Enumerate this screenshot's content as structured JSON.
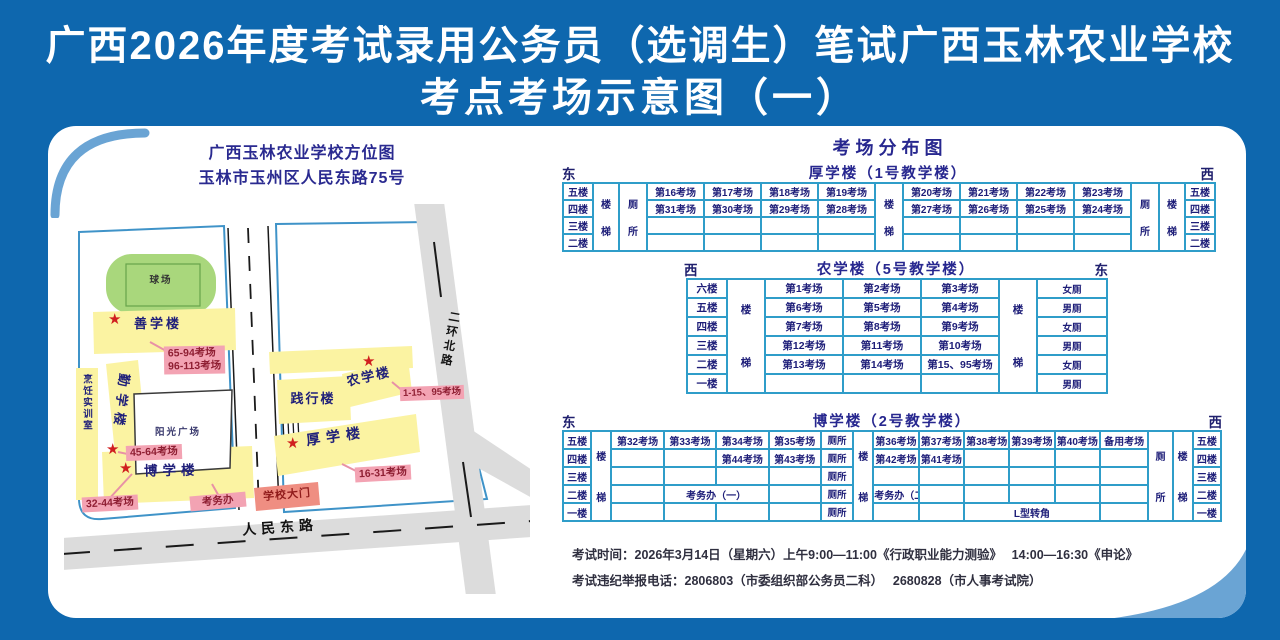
{
  "title": {
    "line1": "广西2026年度考试录用公务员（选调生）笔试广西玉林农业学校",
    "line2": "考点考场示意图（一）"
  },
  "icons": {
    "star": "★"
  },
  "colors": {
    "page_bg": "#0e67ae",
    "table_border": "#2f9dc9",
    "heading": "#27278f",
    "cell_text": "#1d1d78",
    "building_yellow": "#fbf3a2",
    "field_green": "#a9d77c",
    "pink_label_bg": "#f3a3b3",
    "pink_label_text": "#8f1f33",
    "gate_bg": "#ef8e82",
    "star_red": "#d01f1f",
    "road_gray": "#dcdcdc",
    "campus_line": "#3f93c8",
    "map_frame": "#37307e"
  },
  "map": {
    "heading_line1": "广西玉林农业学校方位图",
    "heading_line2": "玉林市玉州区人民东路75号",
    "buildings": {
      "sports_field": "球场",
      "shanxuelou": "善学楼",
      "qinxuelou": "勤学楼",
      "pengren": "烹饪实训室",
      "yangguang": "阳光广场",
      "boxuelou": "博学楼",
      "jianxinglou": "践行楼",
      "nongxuelou": "农学楼",
      "houxuelou": "厚学楼",
      "gate": "学校大门",
      "kaowuban": "考务办"
    },
    "room_labels": {
      "l65": "65-94考场",
      "l96": "96-113考场",
      "l45": "45-64考场",
      "l32": "32-44考场",
      "l1": "1-15、95考场",
      "l16": "16-31考场"
    },
    "roads": {
      "renmin": "人民东路",
      "erhuan": "二环北路"
    }
  },
  "distribution": {
    "title": "考场分布图",
    "tables": [
      {
        "title": "厚学楼（1号教学楼）",
        "dir_left": "东",
        "dir_right": "西",
        "rows": [
          [
            {
              "t": "五楼",
              "cls": "floor"
            },
            {
              "t": "楼梯",
              "v": 1,
              "rs": 4
            },
            {
              "t": "厕所",
              "v": 1,
              "rs": 4
            },
            "第16考场",
            "第17考场",
            "第18考场",
            "第19考场",
            {
              "t": "楼梯",
              "v": 1,
              "rs": 4
            },
            "第20考场",
            "第21考场",
            "第22考场",
            "第23考场",
            {
              "t": "厕所",
              "v": 1,
              "rs": 4
            },
            {
              "t": "楼梯",
              "v": 1,
              "rs": 4
            },
            {
              "t": "五楼",
              "cls": "floor"
            }
          ],
          [
            {
              "t": "四楼",
              "cls": "floor"
            },
            "第31考场",
            "第30考场",
            "第29考场",
            "第28考场",
            "第27考场",
            "第26考场",
            "第25考场",
            "第24考场",
            {
              "t": "四楼",
              "cls": "floor"
            }
          ],
          [
            {
              "t": "三楼",
              "cls": "floor"
            },
            "",
            "",
            "",
            "",
            "",
            "",
            "",
            "",
            {
              "t": "三楼",
              "cls": "floor"
            }
          ],
          [
            {
              "t": "二楼",
              "cls": "floor"
            },
            "",
            "",
            "",
            "",
            "",
            "",
            "",
            "",
            {
              "t": "二楼",
              "cls": "floor"
            }
          ]
        ]
      },
      {
        "title": "农学楼（5号教学楼）",
        "dir_left": "西",
        "dir_right": "东",
        "rows": [
          [
            {
              "t": "六楼",
              "cls": "floor"
            },
            {
              "t": "楼梯",
              "v": 1,
              "rs": 6
            },
            "第1考场",
            "第2考场",
            "第3考场",
            {
              "t": "楼梯",
              "v": 1,
              "rs": 6
            },
            {
              "t": "女厕",
              "cls": "wc"
            }
          ],
          [
            {
              "t": "五楼",
              "cls": "floor"
            },
            "第6考场",
            "第5考场",
            "第4考场",
            {
              "t": "男厕",
              "cls": "wc"
            }
          ],
          [
            {
              "t": "四楼",
              "cls": "floor"
            },
            "第7考场",
            "第8考场",
            "第9考场",
            {
              "t": "女厕",
              "cls": "wc"
            }
          ],
          [
            {
              "t": "三楼",
              "cls": "floor"
            },
            "第12考场",
            "第11考场",
            "第10考场",
            {
              "t": "男厕",
              "cls": "wc"
            }
          ],
          [
            {
              "t": "二楼",
              "cls": "floor"
            },
            "第13考场",
            "第14考场",
            "第15、95考场",
            {
              "t": "女厕",
              "cls": "wc"
            }
          ],
          [
            {
              "t": "一楼",
              "cls": "floor"
            },
            "",
            "",
            "",
            {
              "t": "男厕",
              "cls": "wc"
            }
          ]
        ]
      },
      {
        "title": "博学楼（2号教学楼）",
        "dir_left": "东",
        "dir_right": "西",
        "rows": [
          [
            {
              "t": "五楼",
              "cls": "floor"
            },
            {
              "t": "楼梯",
              "v": 1,
              "rs": 5
            },
            "第32考场",
            "第33考场",
            "第34考场",
            "第35考场",
            {
              "t": "厕所",
              "cls": "wc"
            },
            {
              "t": "楼梯",
              "v": 1,
              "rs": 5
            },
            "第36考场",
            "第37考场",
            "第38考场",
            "第39考场",
            "第40考场",
            "备用考场",
            {
              "t": "厕所",
              "v": 1,
              "rs": 5
            },
            {
              "t": "楼梯",
              "v": 1,
              "rs": 5
            },
            {
              "t": "五楼",
              "cls": "floor"
            }
          ],
          [
            {
              "t": "四楼",
              "cls": "floor"
            },
            "",
            "",
            "第44考场",
            "第43考场",
            {
              "t": "厕所",
              "cls": "wc"
            },
            "第42考场",
            "第41考场",
            "",
            "",
            "",
            "",
            {
              "t": "四楼",
              "cls": "floor"
            }
          ],
          [
            {
              "t": "三楼",
              "cls": "floor"
            },
            "",
            "",
            "",
            "",
            {
              "t": "厕所",
              "cls": "wc"
            },
            "",
            "",
            "",
            "",
            "",
            "",
            {
              "t": "三楼",
              "cls": "floor"
            }
          ],
          [
            {
              "t": "二楼",
              "cls": "floor"
            },
            "",
            {
              "t": "考务办（一）",
              "cs": 2
            },
            "",
            {
              "t": "厕所",
              "cls": "wc"
            },
            {
              "t": "考务办（二）"
            },
            "",
            "",
            "",
            "",
            "",
            {
              "t": "二楼",
              "cls": "floor"
            }
          ],
          [
            {
              "t": "一楼",
              "cls": "floor"
            },
            "",
            "",
            "",
            "",
            {
              "t": "厕所",
              "cls": "wc"
            },
            "",
            "",
            {
              "t": "L型转角",
              "cs": 3
            },
            "",
            {
              "t": "一楼",
              "cls": "floor"
            }
          ]
        ]
      }
    ]
  },
  "footer": {
    "line1": "考试时间：2026年3月14日（星期六）上午9:00—11:00《行政职业能力测验》　 14:00—16:30《申论》",
    "line2": "考试违纪举报电话：2806803（市委组织部公务员二科）　 2680828（市人事考试院）"
  }
}
